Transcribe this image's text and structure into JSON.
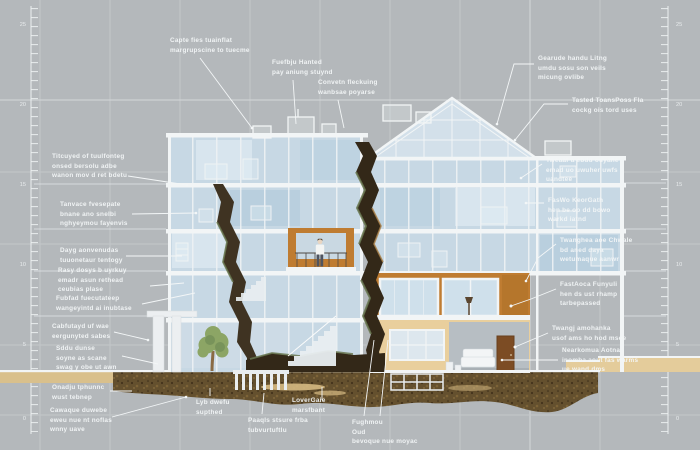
{
  "labels": {
    "top_1": "Capte fies tuainflat\nmargrupscine to tuecme",
    "top_2": "Fuefbju Hanted\npay aniung stuynd",
    "top_3": "Convetn fleckuing\nwanbsae poyarse",
    "top_right_1": "Gearude handu Litng\numdu sosu son veils\nmicung ovlibe",
    "top_right_2": "Tasted ToansPoss Fla\ncockg ois tord uses",
    "left_1": "Titcuyed of tuulfonteg\nonsed bersolu adbe\nwanon mov d ret bdetu",
    "left_2": "Tanvace fvesepate\nbnane ano snelbi\nnghyeymou fayenvis",
    "left_3": "Dayg aonvenudas\ntuuonetaur tentogy",
    "left_4": "Rasy dosys b uyrkuy\nemadr asun rethead\nceubias plase",
    "left_5": "Fubfad fuecutateep\nwangeyintd ai inubtase",
    "left_6": "Cabfutayd uf wae\neergunyted sabes",
    "left_7": "Sddu dunse\nsoyne as scane\nswag y obe ut awn",
    "bottom_left_1": "Onadju tphunnc\nwust tebnep",
    "bottom_left_2": "Cawaque duwebe\neweu nue nt noflas\nwnny uave",
    "bottom_1": "Lyb dwefu\nsupthed",
    "bottom_2": "Paaqls stsure frba\ntubvurtuftlu",
    "bottom_3": "LoverGaie\nmarsfbant",
    "bottom_4": "Fughmou\nOud\nbevoque nue moyac",
    "right_1": "Tweaaf a ebdu ouyane\nemad uo uwuher uwfs\nuandtee",
    "right_2": "FasWo KeorGath\nhen be op dd bowo\nwarkd iatnd",
    "right_3": "Twanghea aoe Chwale\nbd aned daya\nwetumaque aanwr",
    "right_4": "FastAoca Funyuli\nhen ds ust rhamp\ntarbepassed",
    "right_5": "Twangj amohanka\nusof ams ho hod msee",
    "right_6": "Nearkomua Aotna\ninomba aout fas warms\nue wand dms"
  },
  "rulers": {
    "left": [
      "25",
      "20",
      "15",
      "10",
      "5",
      "0"
    ],
    "right": [
      "25",
      "20",
      "15",
      "10",
      "5",
      "0"
    ]
  },
  "palette": {
    "background": "#b4b8bb",
    "grid_line": "#c3c7ca",
    "glass": "#c7d8e4",
    "glass_light": "#d8e5ee",
    "frame_white": "#f2f5f6",
    "wall_orange": "#bf7c31",
    "wall_tan": "#e9cf9d",
    "soil_brown": "#5c4729",
    "crack_dark": "#332818",
    "moss_green": "#687750",
    "door_brown": "#7c4c24",
    "tree_green": "#8ca565",
    "label_text": "#f4f7f8"
  }
}
